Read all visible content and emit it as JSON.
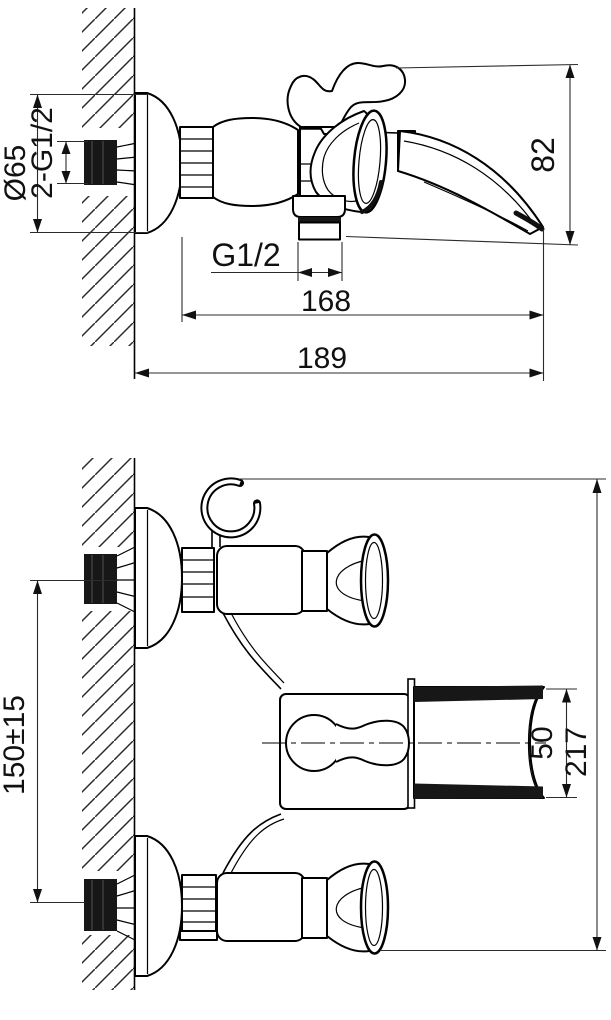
{
  "drawing": {
    "dimensions": {
      "escutcheon_diameter": "Ø65",
      "wall_inlet_threads": "2-G1/2",
      "outlet_thread": "G1/2",
      "spout_reach": "168",
      "overall_depth": "189",
      "body_height": "82",
      "inlet_centres": "150±15",
      "spout_end_width": "50",
      "overall_width": "217"
    }
  }
}
